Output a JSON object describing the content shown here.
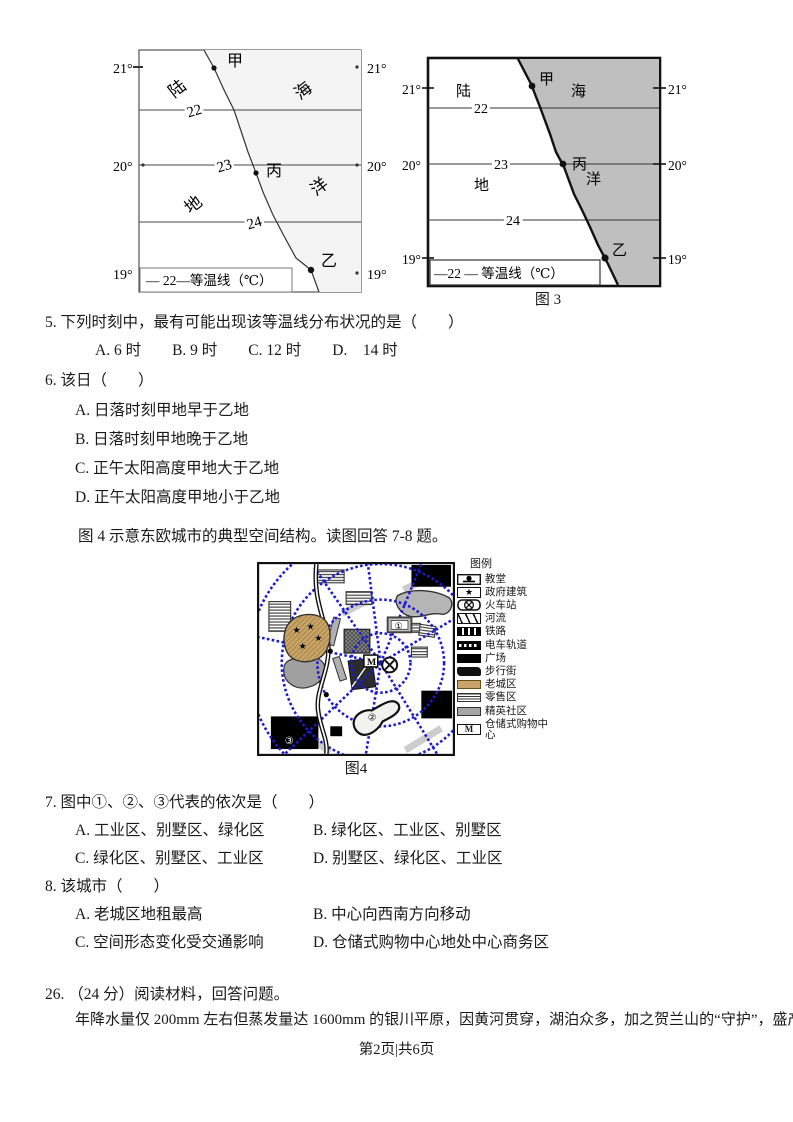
{
  "page": {
    "footer": "第2页|共6页"
  },
  "map_a": {
    "lat_left": [
      "21°",
      "20°",
      "19°"
    ],
    "lat_right": [
      "21°",
      "20°",
      "19°"
    ],
    "isotherms": [
      "22",
      "23",
      "24"
    ],
    "point_jia": "甲",
    "point_bing": "丙",
    "point_yi": "乙",
    "region_lu": "陆",
    "region_hai": "海",
    "region_di": "地",
    "region_yang": "洋",
    "legend": "— 22—等温线（℃）"
  },
  "map_b": {
    "lat_left": [
      "21°",
      "20°",
      "19°"
    ],
    "lat_right": [
      "21°",
      "20°",
      "19°"
    ],
    "isotherms": [
      "22",
      "23",
      "24"
    ],
    "point_jia": "甲",
    "point_bing": "丙",
    "point_yi": "乙",
    "region_lu": "陆",
    "region_hai": "海",
    "region_di": "地",
    "region_yang": "洋",
    "legend": "—22 —  等温线（℃）",
    "caption": "图 3"
  },
  "q5": {
    "text": "5. 下列时刻中，最有可能出现该等温线分布状况的是（　　）",
    "options": "A. 6 时　　B. 9 时　　C. 12 时　　D.　14 时"
  },
  "q6": {
    "text": "6. 该日（　　）",
    "options": [
      "A. 日落时刻甲地早于乙地",
      "B. 日落时刻甲地晚于乙地",
      "C. 正午太阳高度甲地大于乙地",
      "D. 正午太阳高度甲地小于乙地"
    ]
  },
  "fig4_intro": "图 4 示意东欧城市的典型空间结构。读图回答 7-8 题。",
  "figure4": {
    "caption": "图4",
    "legend_title": "图例",
    "legend_items": [
      {
        "label": "教堂"
      },
      {
        "label": "政府建筑"
      },
      {
        "label": "火车站"
      },
      {
        "label": "河流"
      },
      {
        "label": "铁路"
      },
      {
        "label": "电车轨道"
      },
      {
        "label": "广场"
      },
      {
        "label": "步行街"
      },
      {
        "label": "老城区"
      },
      {
        "label": "零售区"
      },
      {
        "label": "精英社区"
      },
      {
        "label": "仓储式购物中心"
      }
    ],
    "marker_m": "M",
    "marker_1": "①",
    "marker_2": "②",
    "marker_3": "③",
    "star_icon": "★"
  },
  "q7": {
    "text": "7. 图中①、②、③代表的依次是（　　）",
    "options": [
      "A. 工业区、别墅区、绿化区",
      "B. 绿化区、工业区、别墅区",
      "C. 绿化区、别墅区、工业区",
      "D. 别墅区、绿化区、工业区"
    ]
  },
  "q8": {
    "text": "8. 该城市（　　）",
    "options": [
      "A. 老城区地租最高",
      "B. 中心向西南方向移动",
      "C. 空间形态变化受交通影响",
      "D. 仓储式购物中心地处中心商务区"
    ]
  },
  "q26": {
    "text": "26. （24 分）阅读材料，回答问题。",
    "material": "年降水量仅 200mm 左右但蒸发量达 1600mm 的银川平原，因黄河贯穿，湖泊众多，加之贺兰山的“守护”，盛产"
  }
}
